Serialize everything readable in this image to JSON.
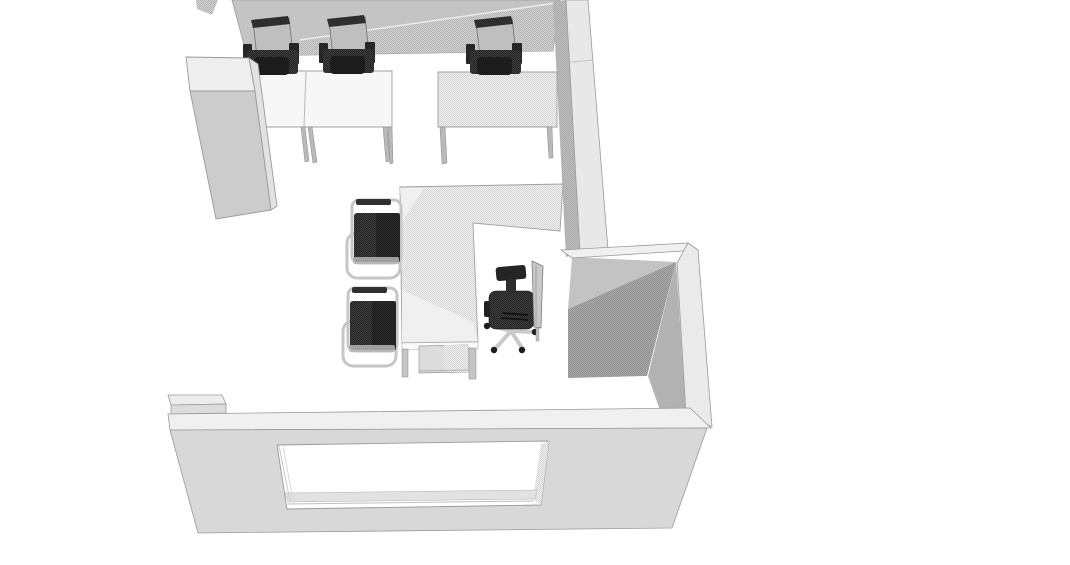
{
  "meta": {
    "content_type": "3d-architectural-render",
    "view": "top-down oblique view of a small office room",
    "app_chrome": "none",
    "visible_text": "none"
  },
  "palette": {
    "background": "#ffffff",
    "floor": "#ffffff",
    "wall_top_gray": "#c4c4c4",
    "wall_outer_light": "#e8e8e8",
    "wall_inner_dark": "#a8a8a8",
    "wall_inner_mid": "#b2b2b2",
    "wall_inner_upper": "#c3c3c3",
    "wall_cap_light": "#f0f0f0",
    "corner_wall_face": "#eaeaea",
    "south_wall_face": "#d8d8d8",
    "south_block_top": "#ededed",
    "south_block_front": "#dcdcdc",
    "cabinet_top": "#eeeeee",
    "cabinet_front": "#cccccc",
    "cabinet_side": "#e2e2e2",
    "desk_white": "#f7f7f7",
    "desk_leg": "#b9b9b9",
    "desk_light_patch": "#f0f0f0",
    "desk_front_band": "#fafafa",
    "drawer_unit": "#dcdcdc",
    "l_desk_leg": "#c4c4c4",
    "monitor_back": "#bfbfbf",
    "monitor_frame": "#2e2e2e",
    "monitor_side_panel": "#c9c9c9",
    "chair_dark": "#262626",
    "chair_seat_dark": "#1c1c1c",
    "chair_frame_light": "#c6c6c6",
    "caster_dark": "#1c1c1c",
    "window_glass": "#ffffff",
    "window_sill": "#e2e2e2",
    "edge_stroke": "#9a9a9a",
    "hatch_light_a": "#d4d4d4",
    "hatch_light_b": "#f1f1f1",
    "hatch_mid_a": "#b4b4b4",
    "hatch_mid_b": "#d2d2d2",
    "hatch_dark_a": "#8f8f8f",
    "hatch_dark_b": "#ababab",
    "dark_dither_a": "#232323",
    "dark_dither_b": "#3f3f3f"
  },
  "scene": {
    "objects": [
      {
        "id": "north-partition-wall",
        "kind": "wall",
        "finish": "gray with dithered texture"
      },
      {
        "id": "right-wall",
        "kind": "wall",
        "finish": "light outer face, dark inner face"
      },
      {
        "id": "corner-wall-return",
        "kind": "wall",
        "finish": "hatched inner corner"
      },
      {
        "id": "south-wall",
        "kind": "wall",
        "features": [
          "window-opening",
          "pillar-block"
        ]
      },
      {
        "id": "tall-cabinet",
        "kind": "storage"
      },
      {
        "id": "workstation-1",
        "kind": "desk",
        "items": [
          "monitor",
          "office-chair"
        ]
      },
      {
        "id": "workstation-2",
        "kind": "desk",
        "items": [
          "monitor",
          "office-chair"
        ]
      },
      {
        "id": "workstation-3",
        "kind": "desk",
        "items": [
          "monitor",
          "office-chair"
        ],
        "finish": "hatched top"
      },
      {
        "id": "l-shaped-desk",
        "kind": "desk",
        "items": [
          "drawer-unit",
          "monitor-side-view"
        ]
      },
      {
        "id": "visitor-chair-1",
        "kind": "chair",
        "style": "cantilever, dark cushion, light frame"
      },
      {
        "id": "visitor-chair-2",
        "kind": "chair",
        "style": "cantilever, dark cushion, light frame"
      },
      {
        "id": "task-chair",
        "kind": "chair",
        "features": [
          "headrest",
          "armrests",
          "five-star-base",
          "casters"
        ]
      }
    ],
    "counts": {
      "walls": 4,
      "desks": 4,
      "chairs": 6,
      "monitors": 4,
      "windows": 1,
      "cabinets": 1
    }
  }
}
